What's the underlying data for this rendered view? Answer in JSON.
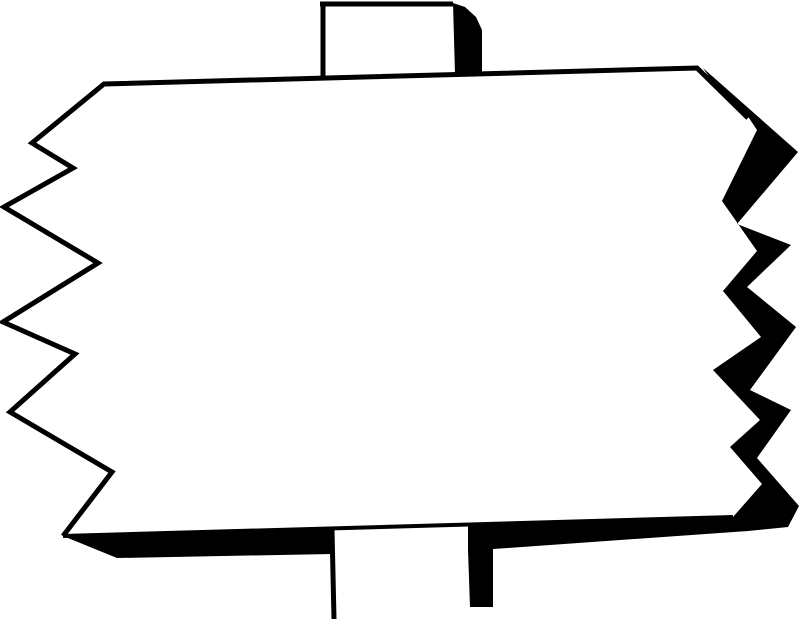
{
  "meta": {
    "description": "Hand-drawn black-and-white clipart of a blank rectangular signboard mounted on a vertical post. The left and right edges of the board are jagged zigzags; the left edge, top edge and post outlines are thin ink lines, while the right zigzag edge, bottom edge and the right sides of both post segments carry a heavy solid-black ink shadow. The face of the sign is empty white with no text."
  },
  "canvas": {
    "width": 800,
    "height": 621,
    "background_color": "#ffffff",
    "ink_color": "#000000"
  },
  "shapes": [
    {
      "name": "sign-board-face",
      "type": "polygon",
      "fill": "#ffffff",
      "points": [
        [
          104,
          84
        ],
        [
          697,
          68
        ],
        [
          757,
          130
        ],
        [
          722,
          201
        ],
        [
          757,
          251
        ],
        [
          723,
          291
        ],
        [
          761,
          337
        ],
        [
          713,
          370
        ],
        [
          760,
          420
        ],
        [
          730,
          447
        ],
        [
          762,
          484
        ],
        [
          733,
          517
        ],
        [
          63,
          536
        ],
        [
          112,
          472
        ],
        [
          10,
          412
        ],
        [
          75,
          354
        ],
        [
          3,
          322
        ],
        [
          98,
          263
        ],
        [
          4,
          207
        ],
        [
          73,
          168
        ],
        [
          32,
          143
        ]
      ]
    },
    {
      "name": "bottom-edge-shadow-left-segment",
      "type": "polygon",
      "fill": "#000000",
      "points": [
        [
          63,
          536
        ],
        [
          332,
          528
        ],
        [
          332,
          554
        ],
        [
          117,
          558
        ]
      ]
    },
    {
      "name": "right-zigzag-and-bottom-shadow",
      "type": "polygon",
      "fill": "#000000",
      "points": [
        [
          703,
          68
        ],
        [
          798,
          152
        ],
        [
          737,
          224
        ],
        [
          791,
          245
        ],
        [
          747,
          287
        ],
        [
          796,
          327
        ],
        [
          750,
          390
        ],
        [
          791,
          410
        ],
        [
          757,
          458
        ],
        [
          799,
          506
        ],
        [
          788,
          527
        ],
        [
          748,
          531
        ],
        [
          493,
          549
        ],
        [
          493,
          607
        ],
        [
          470,
          607
        ],
        [
          468,
          550
        ],
        [
          468,
          525
        ],
        [
          733,
          517
        ],
        [
          762,
          484
        ],
        [
          730,
          447
        ],
        [
          760,
          420
        ],
        [
          713,
          370
        ],
        [
          761,
          337
        ],
        [
          723,
          291
        ],
        [
          757,
          251
        ],
        [
          722,
          201
        ],
        [
          757,
          130
        ],
        [
          745,
          112
        ],
        [
          710,
          78
        ]
      ]
    },
    {
      "name": "top-post-right-shadow",
      "type": "polygon",
      "fill": "#000000",
      "points": [
        [
          453,
          3
        ],
        [
          465,
          7
        ],
        [
          476,
          17
        ],
        [
          482,
          30
        ],
        [
          482,
          74
        ],
        [
          455,
          74
        ]
      ]
    },
    {
      "name": "board-left-and-top-outline",
      "type": "polyline",
      "fill": "none",
      "stroke": "#000000",
      "stroke_width": 5,
      "points": [
        [
          63,
          536
        ],
        [
          112,
          472
        ],
        [
          10,
          412
        ],
        [
          75,
          354
        ],
        [
          3,
          322
        ],
        [
          98,
          263
        ],
        [
          4,
          207
        ],
        [
          73,
          168
        ],
        [
          32,
          143
        ],
        [
          104,
          84
        ],
        [
          697,
          68
        ],
        [
          748,
          118
        ]
      ]
    },
    {
      "name": "board-bottom-edge-line",
      "type": "polyline",
      "fill": "none",
      "stroke": "#000000",
      "stroke_width": 4,
      "points": [
        [
          63,
          536
        ],
        [
          733,
          517
        ]
      ]
    },
    {
      "name": "top-post-left-line",
      "type": "polyline",
      "fill": "none",
      "stroke": "#000000",
      "stroke_width": 5,
      "points": [
        [
          323,
          77
        ],
        [
          323,
          3
        ]
      ]
    },
    {
      "name": "top-post-top-line",
      "type": "polyline",
      "fill": "none",
      "stroke": "#000000",
      "stroke_width": 5,
      "points": [
        [
          320,
          4
        ],
        [
          453,
          4
        ]
      ]
    },
    {
      "name": "bottom-post-left-line",
      "type": "polyline",
      "fill": "none",
      "stroke": "#000000",
      "stroke_width": 5,
      "points": [
        [
          332,
          530
        ],
        [
          334,
          619
        ]
      ]
    }
  ]
}
